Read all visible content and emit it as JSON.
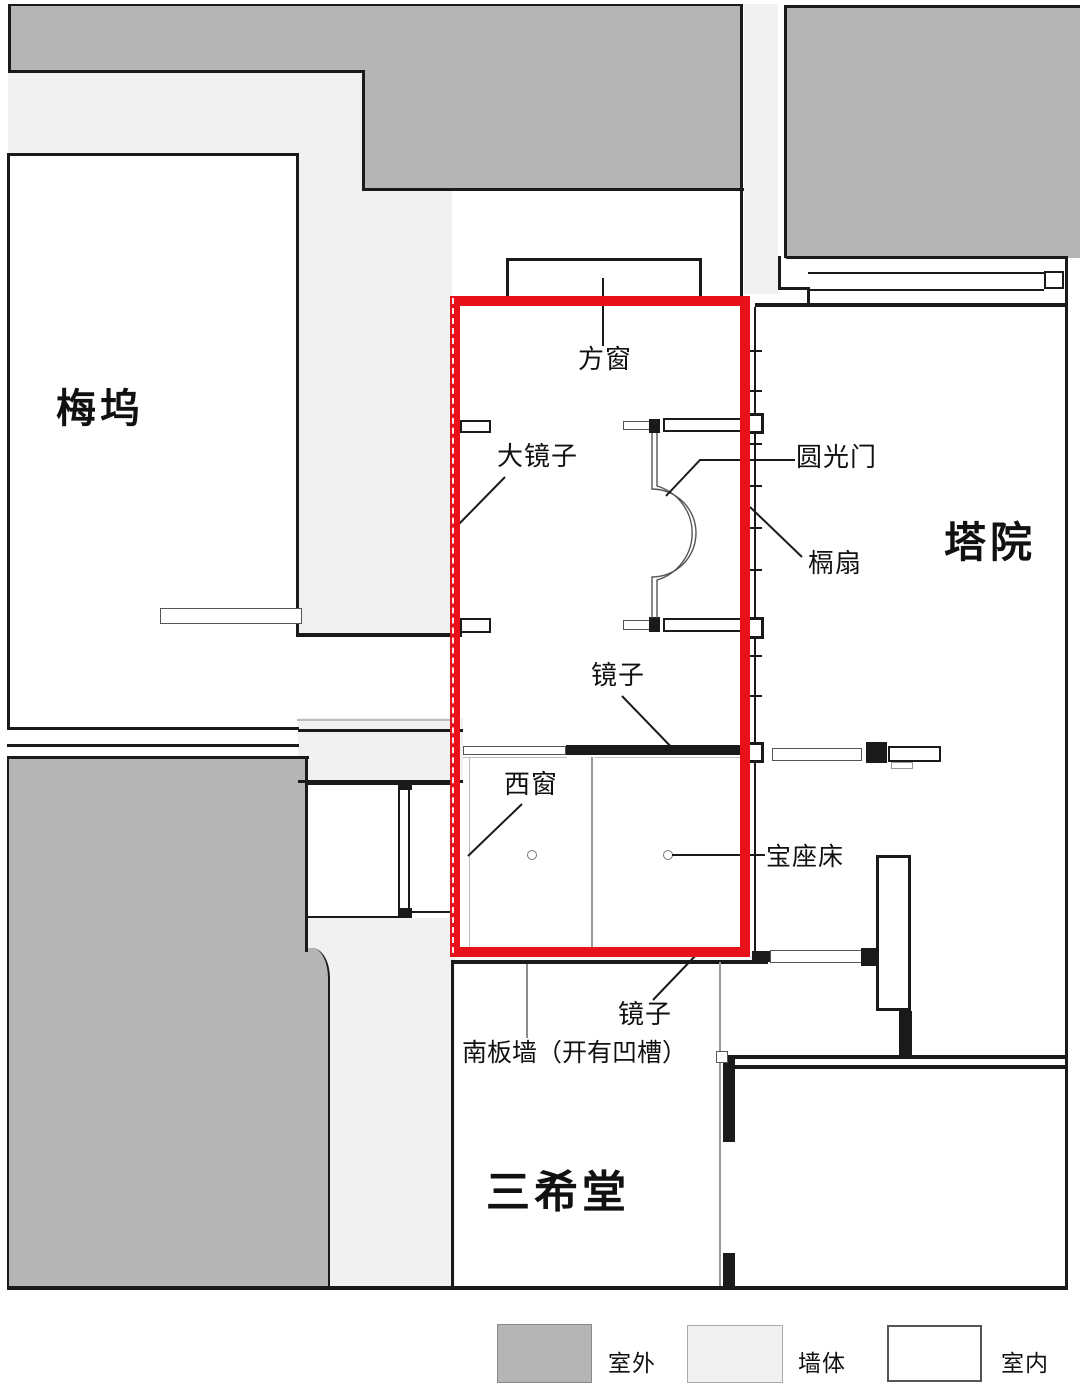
{
  "rooms": {
    "meiwu": "梅坞",
    "tayuan": "塔院",
    "sanxitang": "三希堂"
  },
  "annotations": {
    "fangchuang": "方窗",
    "dajingzi": "大镜子",
    "yuanguangmen": "圆光门",
    "geshan": "槅扇",
    "jingzi_north": "镜子",
    "xichuang": "西窗",
    "baozuochuang": "宝座床",
    "jingzi_south": "镜子",
    "nanbanqiang": "南板墙（开有凹槽）"
  },
  "legend": {
    "items": [
      {
        "label": "室外",
        "color": "#b5b5b5"
      },
      {
        "label": "墙体",
        "color": "#f1f1f1"
      },
      {
        "label": "室内",
        "color": "#ffffff"
      }
    ]
  },
  "colors": {
    "highlight_box": "#e8101a",
    "line": "#1a1a1a",
    "outdoor": "#b5b5b5",
    "wall": "#f1f1f1",
    "indoor": "#ffffff"
  }
}
